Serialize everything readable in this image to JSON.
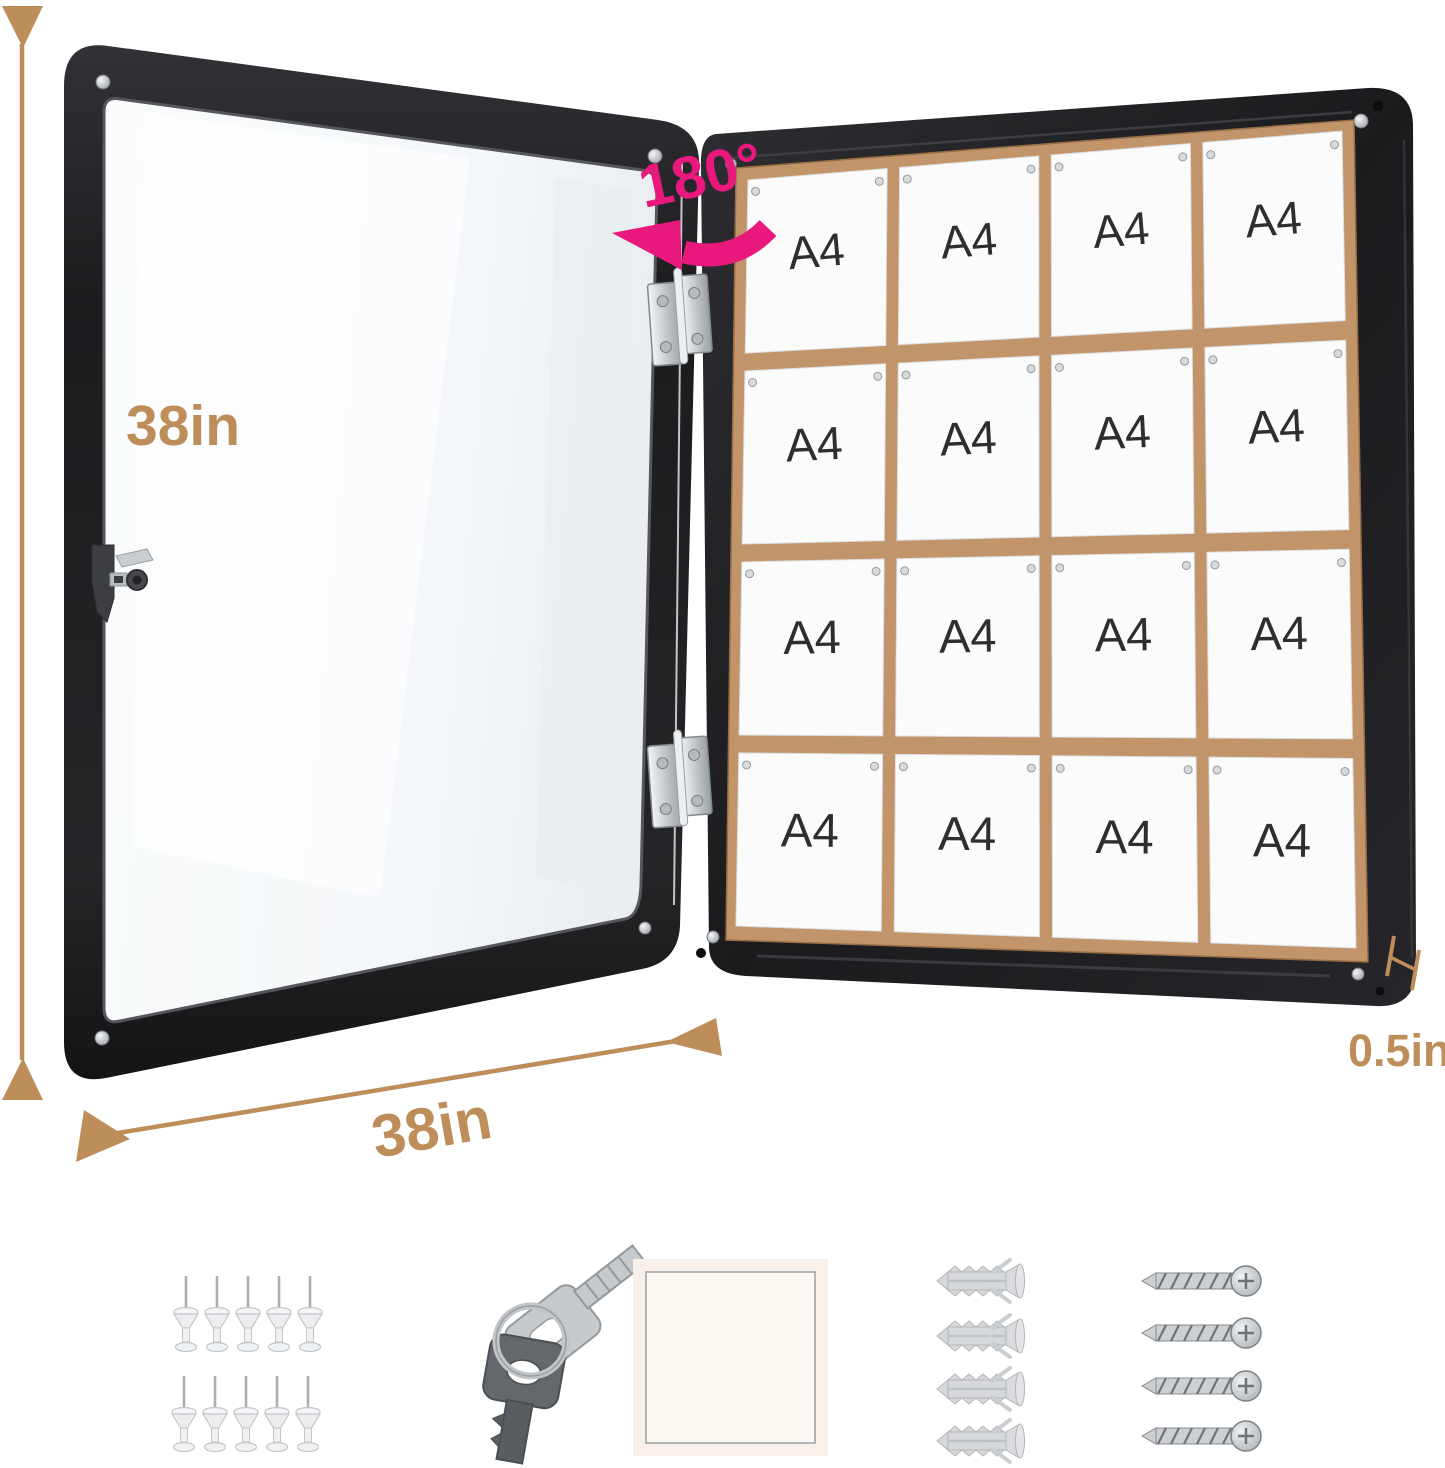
{
  "annotations": {
    "height_label": "38in",
    "width_label": "38in",
    "depth_label": "0.5in",
    "rotation_label": "180°"
  },
  "board": {
    "paper_label": "A4",
    "rows": 4,
    "cols": 4,
    "paper_count": 16
  },
  "accessories": {
    "push_pins": {
      "count": 10
    },
    "keys": {
      "count": 2
    },
    "mounting_square": {
      "count": 1
    },
    "wall_anchors": {
      "count": 4
    },
    "screws": {
      "count": 4
    }
  },
  "colors": {
    "annotation_tan": "#bd8d5a",
    "accent_pink": "#e9187c",
    "frame_black": "#202023",
    "cork": "#c2946a",
    "cork_dark": "#a57b50",
    "paper": "#fbfbfc",
    "paper_text": "#2e2e30",
    "metal_light": "#e9ecee",
    "metal_mid": "#c7cbce",
    "metal_dark": "#8c9195"
  }
}
